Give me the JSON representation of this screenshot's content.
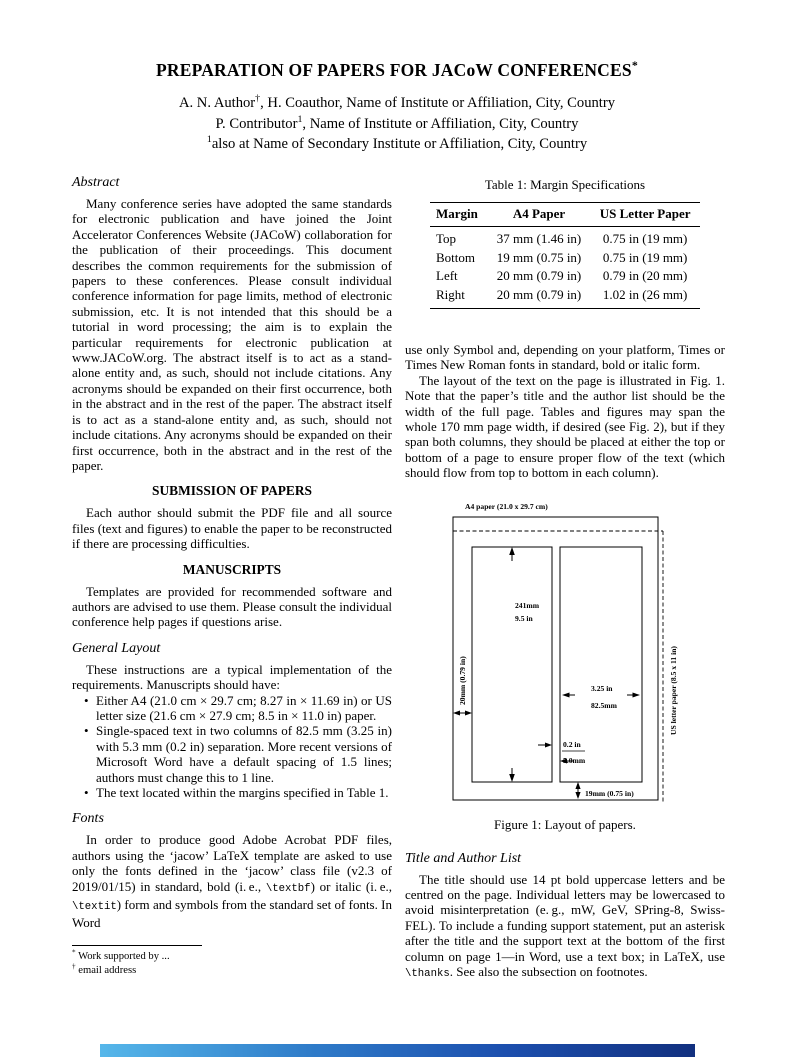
{
  "colors": {
    "page_bg": "#ffffff",
    "text": "#000000",
    "bar_gradient": [
      "#56b7ea",
      "#2f7cc9",
      "#1c4fae",
      "#12307f"
    ]
  },
  "header": {
    "title": [
      {
        "t": "PREPARATION OF PAPERS FOR JACoW CONFERENCES"
      },
      {
        "t": "*",
        "sup": true
      }
    ],
    "author_lines": [
      [
        {
          "t": "A. N. Author"
        },
        {
          "t": "†",
          "sup": true
        },
        {
          "t": ", H. Coauthor, Name of Institute or Affiliation, City, Country"
        }
      ],
      [
        {
          "t": "P. Contributor"
        },
        {
          "t": "1",
          "sup": true
        },
        {
          "t": ", Name of Institute or Affiliation, City, Country"
        }
      ],
      [
        {
          "t": "1",
          "sup": true
        },
        {
          "t": "also at Name of Secondary Institute or Affiliation, City, Country"
        }
      ]
    ]
  },
  "abstract": {
    "heading": "Abstract",
    "body": "Many conference series have adopted the same standards for electronic publication and have joined the Joint Accelerator Conferences Website (JACoW) collaboration for the publication of their proceedings. This document describes the common requirements for the submission of papers to these conferences. Please consult individual conference information for page limits, method of electronic submission, etc. It is not intended that this should be a tutorial in word processing; the aim is to explain the particular requirements for electronic publication at www.JACoW.org. The abstract itself is to act as a stand-alone entity and, as such, should not include citations. Any acronyms should be expanded on their first occurrence, both in the abstract and in the rest of the paper. The abstract itself is to act as a stand-alone entity and, as such, should not include citations. Any acronyms should be expanded on their first occurrence, both in the abstract and in the rest of the paper."
  },
  "submission": {
    "heading": "SUBMISSION OF PAPERS",
    "body": "Each author should submit the PDF file and all source files (text and figures) to enable the paper to be reconstructed if there are processing difficulties."
  },
  "manuscripts": {
    "heading": "MANUSCRIPTS",
    "body": "Templates are provided for recommended software and authors are advised to use them. Please consult the individual conference help pages if questions arise."
  },
  "general_layout": {
    "heading": "General Layout",
    "intro": "These instructions are a typical implementation of the requirements. Manuscripts should have:",
    "bullets": [
      "Either A4 (21.0 cm × 29.7 cm; 8.27 in × 11.69 in) or US letter size (21.6 cm × 27.9 cm; 8.5 in × 11.0 in) paper.",
      "Single-spaced text in two columns of 82.5 mm (3.25 in) with 5.3 mm (0.2 in) separation. More recent versions of Microsoft Word have a default spacing of 1.5 lines; authors must change this to 1 line.",
      "The text located within the margins specified in Table 1."
    ]
  },
  "fonts": {
    "heading": "Fonts",
    "body": [
      {
        "t": "In order to produce good Adobe Acrobat PDF files, authors using the ‘jacow’ LaTeX template are asked to use only the fonts defined in the ‘jacow’ class file (v2.3 of 2019/01/15) in standard, bold (i. e., "
      },
      {
        "t": "\\textbf",
        "mono": true
      },
      {
        "t": ") or italic (i. e., "
      },
      {
        "t": "\\textit",
        "mono": true
      },
      {
        "t": ") form and symbols from the standard set of fonts. In Word"
      }
    ]
  },
  "footnotes": {
    "items": [
      {
        "marker": "*",
        "text": "Work supported by ..."
      },
      {
        "marker": "†",
        "text": "email address"
      }
    ]
  },
  "table": {
    "caption": "Table 1: Margin Specifications",
    "headers": [
      "Margin",
      "A4 Paper",
      "US Letter Paper"
    ],
    "rows": [
      [
        "Top",
        "37 mm (1.46 in)",
        "0.75 in (19 mm)"
      ],
      [
        "Bottom",
        "19 mm (0.75 in)",
        "0.75 in (19 mm)"
      ],
      [
        "Left",
        "20 mm (0.79 in)",
        "0.79 in (20 mm)"
      ],
      [
        "Right",
        "20 mm (0.79 in)",
        "1.02 in (26 mm)"
      ]
    ]
  },
  "body_right": {
    "para1": "use only Symbol and, depending on your platform, Times or Times New Roman fonts in standard, bold or italic form.",
    "para2": "The layout of the text on the page is illustrated in Fig. 1. Note that the paper’s title and the author list should be the width of the full page. Tables and figures may span the whole 170 mm page width, if desired (see Fig. 2), but if they span both columns, they should be placed at either the top or bottom of a page to ensure proper flow of the text (which should flow from top to bottom in each column)."
  },
  "figure": {
    "a4_label": "A4 paper (21.0 x 29.7 cm)",
    "us_label": "US letter paper (8.5 x 11 in)",
    "col_height_mm": "241mm",
    "col_height_in": "9.5 in",
    "left_margin": "20mm (0.79 in)",
    "col_width_in": "3.25 in",
    "col_width_mm": "82.5mm",
    "gutter_in": "0.2 in",
    "gutter_mm": "5.0mm",
    "bottom_margin": "19mm (0.75 in)",
    "caption": "Figure 1: Layout of papers."
  },
  "title_author": {
    "heading": "Title and Author List",
    "body": [
      {
        "t": "The title should use 14 pt bold uppercase letters and be centred on the page. Individual letters may be lowercased to avoid misinterpretation (e. g., mW, GeV, SPring-8, Swiss-FEL). To include a funding support statement, put an asterisk after the title and the support text at the bottom of the first column on page 1—in Word, use a text box; in LaTeX, use "
      },
      {
        "t": "\\thanks",
        "mono": true
      },
      {
        "t": ". See also the subsection on footnotes."
      }
    ]
  }
}
